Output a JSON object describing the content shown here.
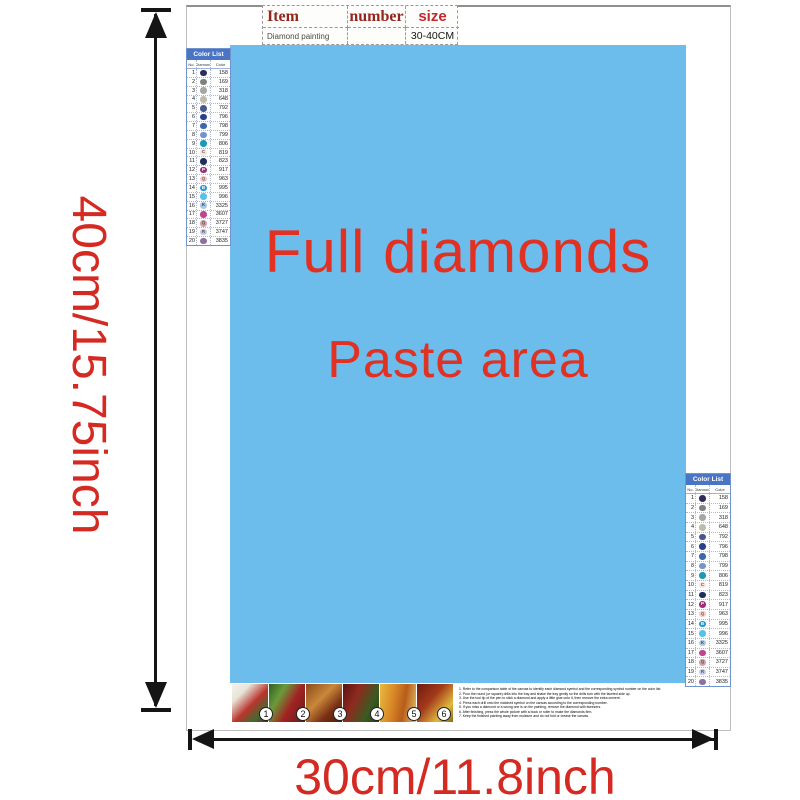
{
  "item_table": {
    "headers": [
      "Item",
      "number",
      "size"
    ],
    "row": {
      "item": "Diamond painting",
      "number": "",
      "size": "30-40CM"
    },
    "header_color": "#93271f",
    "size_color": "#c22a2c"
  },
  "paste_area": {
    "line1": "Full diamonds",
    "line2": "Paste area",
    "bg": "#6cbdec",
    "text_color": "#e03122"
  },
  "dimensions": {
    "height_label": "40cm/15.75inch",
    "width_label": "30cm/11.8inch",
    "color": "#d42a22",
    "arrow_color": "#151515"
  },
  "color_list": {
    "title": "Color List",
    "title_bg": "#4a74c4",
    "columns": [
      "No.",
      "Diamond",
      "Color"
    ],
    "rows": [
      {
        "no": "1",
        "code": "158",
        "color": "#2e2d5c",
        "sym": "",
        "sym_color": "#ffffff"
      },
      {
        "no": "2",
        "code": "169",
        "color": "#808080",
        "sym": "",
        "sym_color": "#ffffff"
      },
      {
        "no": "3",
        "code": "318",
        "color": "#a6a6a6",
        "sym": "",
        "sym_color": "#ffffff"
      },
      {
        "no": "4",
        "code": "648",
        "color": "#bdbbae",
        "sym": "",
        "sym_color": "#ffffff"
      },
      {
        "no": "5",
        "code": "792",
        "color": "#47578f",
        "sym": "",
        "sym_color": "#ffffff"
      },
      {
        "no": "6",
        "code": "796",
        "color": "#2a418a",
        "sym": "",
        "sym_color": "#ffffff"
      },
      {
        "no": "7",
        "code": "798",
        "color": "#3c68ae",
        "sym": "",
        "sym_color": "#ffffff"
      },
      {
        "no": "8",
        "code": "799",
        "color": "#7593cd",
        "sym": "",
        "sym_color": "#ffffff"
      },
      {
        "no": "9",
        "code": "806",
        "color": "#1f97b9",
        "sym": "",
        "sym_color": "#ffffff"
      },
      {
        "no": "10",
        "code": "819",
        "color": "#f8e4e1",
        "sym": "C",
        "sym_color": "#555555"
      },
      {
        "no": "11",
        "code": "823",
        "color": "#202f5c",
        "sym": "",
        "sym_color": "#ffffff"
      },
      {
        "no": "12",
        "code": "917",
        "color": "#9d2e76",
        "sym": "P",
        "sym_color": "#ffffff"
      },
      {
        "no": "13",
        "code": "963",
        "color": "#f4cbc6",
        "sym": "Q",
        "sym_color": "#776666"
      },
      {
        "no": "14",
        "code": "995",
        "color": "#2398d5",
        "sym": "B",
        "sym_color": "#ffffff"
      },
      {
        "no": "15",
        "code": "996",
        "color": "#56c1e9",
        "sym": "",
        "sym_color": "#ffffff"
      },
      {
        "no": "16",
        "code": "3325",
        "color": "#abc8e3",
        "sym": "K",
        "sym_color": "#444455"
      },
      {
        "no": "17",
        "code": "3607",
        "color": "#bc4692",
        "sym": "",
        "sym_color": "#ffffff"
      },
      {
        "no": "18",
        "code": "3727",
        "color": "#d0a1ae",
        "sym": "Q",
        "sym_color": "#665544"
      },
      {
        "no": "19",
        "code": "3747",
        "color": "#c7cae7",
        "sym": "R",
        "sym_color": "#555566"
      },
      {
        "no": "20",
        "code": "3835",
        "color": "#8f6ea1",
        "sym": "",
        "sym_color": "#ffffff"
      }
    ]
  },
  "thumbnails": [
    {
      "label": "1",
      "gradient": "linear-gradient(135deg,#f5f2ea 0%,#e8e4d8 25%,#b8352c 55%,#3f6b33 80%,#7a1e1e 100%)"
    },
    {
      "label": "2",
      "gradient": "linear-gradient(120deg,#2f5e23 0%,#6a9a3a 30%,#a32222 60%,#57201a 100%)"
    },
    {
      "label": "3",
      "gradient": "linear-gradient(135deg,#8a4a1c 0%,#c9883a 40%,#7a3014 70%,#4a1c10 100%)"
    },
    {
      "label": "4",
      "gradient": "linear-gradient(115deg,#5c1212 0%,#8f2a1e 35%,#3c5a22 70%,#27401a 100%)"
    },
    {
      "label": "5",
      "gradient": "linear-gradient(100deg,#e9b93f 0%,#d98a28 35%,#b85c1b 65%,#e3c566 100%)"
    },
    {
      "label": "6",
      "gradient": "linear-gradient(130deg,#6e1a10 0%,#a33a1a 40%,#e0b93e 75%,#8a6a1f 100%)"
    }
  ],
  "instructions": {
    "lines": [
      "1. Refer to the comparison table of the canvas to identify each diamond symbol and the corresponding symbol number on the color list.",
      "2. Pour the round (or square) drills into the tray and shake the tray gently so the drills turn with the faceted side up.",
      "3. Use the tool tip of the pen to stick a diamond and apply a little glue onto it, then remove the extra cement.",
      "4. Press each drill onto the matched symbol on the canvas according to the corresponding number.",
      "5. If you miss a diamond or a wrong one is on the painting, remove the diamond with tweezers.",
      "6. After finishing, press the whole picture with a book or roller to make the diamonds firm.",
      "7. Keep the finished painting away from moisture and do not fold or crease the canvas."
    ]
  }
}
